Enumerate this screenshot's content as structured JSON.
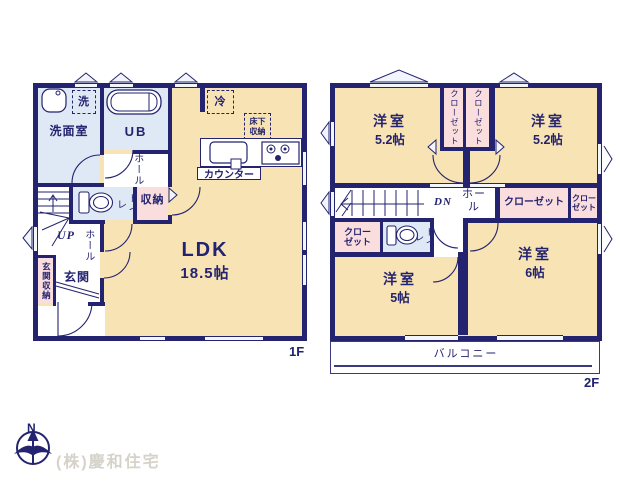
{
  "colors": {
    "wall": "#23236f",
    "room_tatami": "#f8e3b4",
    "room_wet": "#dfe9f6",
    "closet_pink": "#fadddd",
    "window_fill": "#f2f5fc",
    "label_text": "#23236f",
    "company_text": "#d5d3c9"
  },
  "company": "(株)慶和住宅",
  "compass": {
    "north": "N"
  },
  "floor1": {
    "tag": "1F",
    "washroom": "洗面室",
    "washer": "洗",
    "unit_bath": "UB",
    "hall_upper": "ホール",
    "fridge": "冷",
    "underfloor_storage": "床下収納",
    "counter": "カウンター",
    "toilet": "トイレ",
    "storage": "収納",
    "up": "UP",
    "hall_lower": "ホール",
    "entrance_storage": "玄関収納",
    "entrance": "玄関",
    "ldk": "LDK",
    "ldk_size": "18.5帖"
  },
  "floor2": {
    "tag": "2F",
    "room_nw": "洋室",
    "room_nw_size": "5.2帖",
    "closet_n1": "クローゼット",
    "closet_n2": "クローゼット",
    "room_ne": "洋室",
    "room_ne_size": "5.2帖",
    "dn": "DN",
    "hall": "ホール",
    "closet_mid": "クローゼット",
    "closet_east": "クローゼット",
    "closet_west": "クローゼット",
    "toilet": "トイレ",
    "room_sw": "洋室",
    "room_sw_size": "5帖",
    "room_se": "洋室",
    "room_se_size": "6帖",
    "balcony": "バルコニー"
  }
}
